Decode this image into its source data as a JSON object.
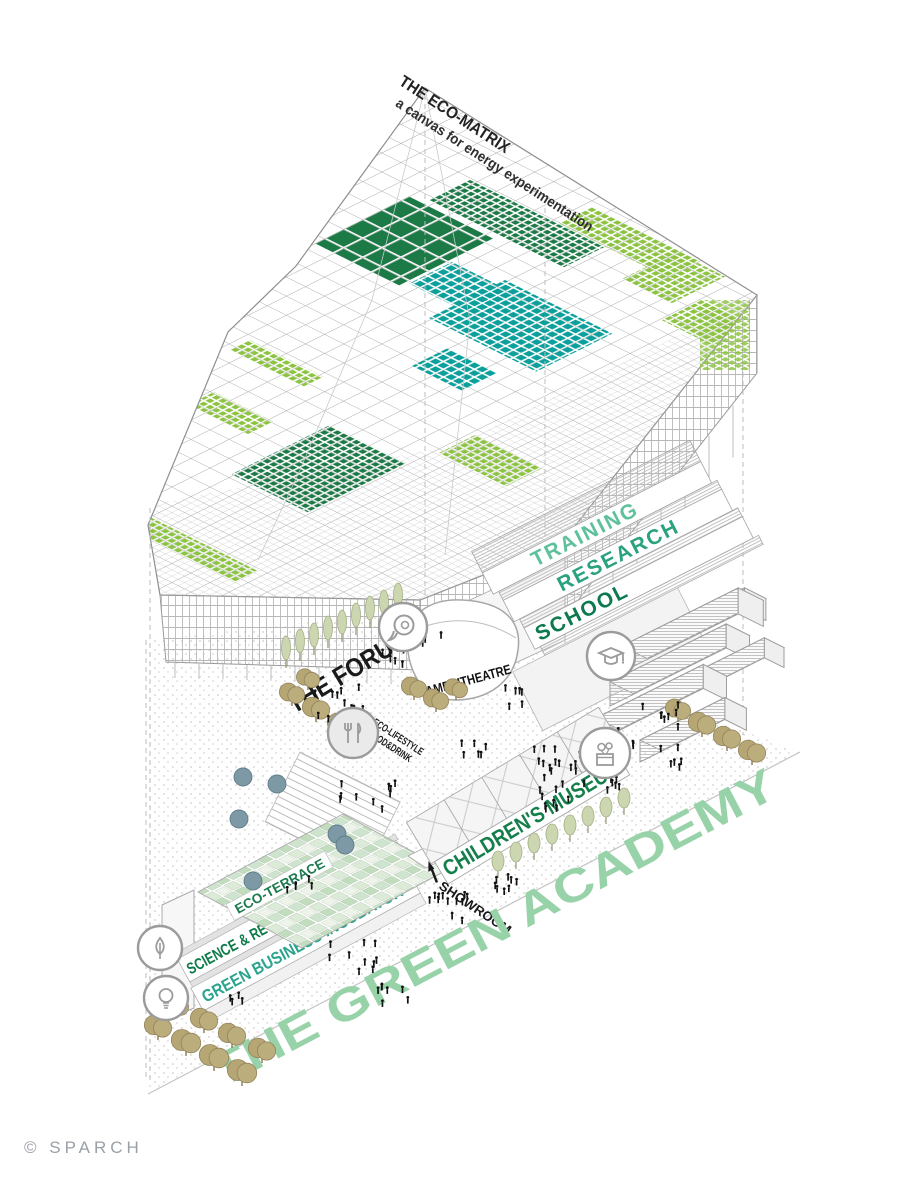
{
  "title": {
    "line1": "THE ECO-MATRIX",
    "line2": "a canvas for energy experimentation"
  },
  "school": {
    "levels": [
      "TRAINING",
      "RESEARCH",
      "SCHOOL"
    ]
  },
  "labels": {
    "forum": "THE FORUM",
    "amphitheatre": "AMPHITHEATRE",
    "food_line1": "ECO-LIFESTYLE",
    "food_line2": "FOOD&DRINK",
    "childrens_museum": "CHILDREN'S MUSEUM",
    "eco_terrace": "ECO-TERRACE",
    "science_museum": "SCIENCE & RECYCLING MUSEUM",
    "incubator": "GREEN BUSINESS INCUBATOR",
    "showroom": "SHOWROOM",
    "site_title": "THE GREEN ACADEMY"
  },
  "credit": "© SPARCH",
  "icons": [
    {
      "name": "speech-bubble-icon",
      "meaning": "forum / dialogue"
    },
    {
      "name": "food-icon",
      "meaning": "eco-lifestyle food & drink"
    },
    {
      "name": "graduation-cap-icon",
      "meaning": "school / training / research"
    },
    {
      "name": "gift-icon",
      "meaning": "children's museum"
    },
    {
      "name": "plant-icon",
      "meaning": "science & recycling museum"
    },
    {
      "name": "lightbulb-icon",
      "meaning": "green business incubator"
    },
    {
      "name": "showroom-arrow-icon",
      "meaning": "arrow pointing to showroom"
    }
  ],
  "palette": {
    "matrix_dark_green": "#1c7a46",
    "matrix_teal": "#0ba09b",
    "matrix_light_green": "#8cc441",
    "training_green": "#5fc19c",
    "research_green": "#2aa17f",
    "school_green": "#0c7a4e",
    "childrens_green": "#157f4c",
    "incubator_teal": "#2aa48e",
    "terrace_green": "#1d7a4f",
    "academy_mint": "#97d2a9",
    "label_black": "#1a1a1a",
    "line_gray": "#9b9b9b",
    "credit_gray": "#9aa0a6"
  }
}
